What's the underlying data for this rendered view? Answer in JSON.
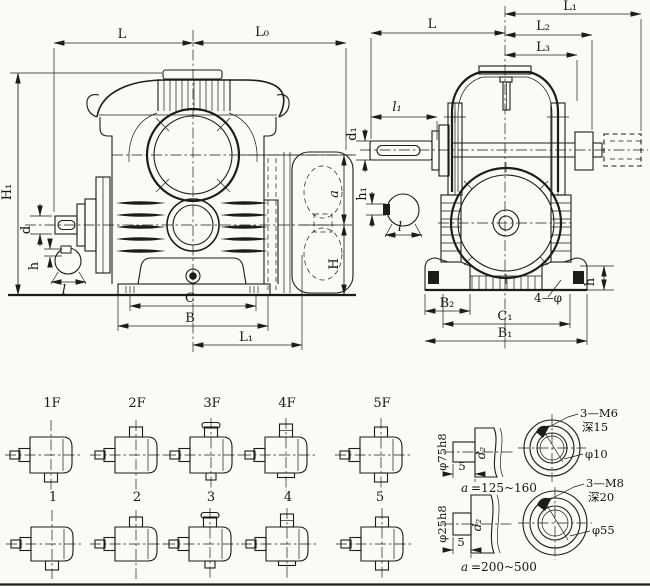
{
  "page": {
    "paper_color": "#fbfaf6",
    "ink_color": "#1d1c1a",
    "kind": "worm gear reducer dimensional drawing"
  },
  "front_view": {
    "dims": {
      "L": "L",
      "L0": "L₀",
      "H1": "H₁",
      "d": "d",
      "h": "h",
      "l": "l",
      "C": "C",
      "B": "B",
      "L1": "L₁",
      "a": "a",
      "H": "H"
    }
  },
  "side_view": {
    "dims": {
      "L1": "L₁",
      "L2": "L₂",
      "L3": "L₃",
      "L": "L",
      "l1": "l₁",
      "d1": "d₁",
      "h1": "h₁",
      "l": "l",
      "B2": "B₂",
      "C1": "C₁",
      "B1": "B₁",
      "feet_holes": "4—φ",
      "h": "h"
    }
  },
  "variants": {
    "fan_row": [
      "1F",
      "2F",
      "3F",
      "4F",
      "5F"
    ],
    "basic_row": [
      "1",
      "2",
      "3",
      "4",
      "5"
    ]
  },
  "shaft_end_details": [
    {
      "pilot_dia": "φ75h8",
      "shaft_dia": "d₂",
      "protrusion": "5",
      "a_label": "a",
      "a_range": "=125~160",
      "tapped_holes": "3—M6",
      "hole_depth": "深15",
      "hole_dia": "φ10"
    },
    {
      "pilot_dia": "φ25h8",
      "shaft_dia": "d₂",
      "protrusion": "5",
      "a_label": "a",
      "a_range": "=200~500",
      "tapped_holes": "3—M8",
      "hole_depth": "深20",
      "hole_dia": "φ55"
    }
  ]
}
